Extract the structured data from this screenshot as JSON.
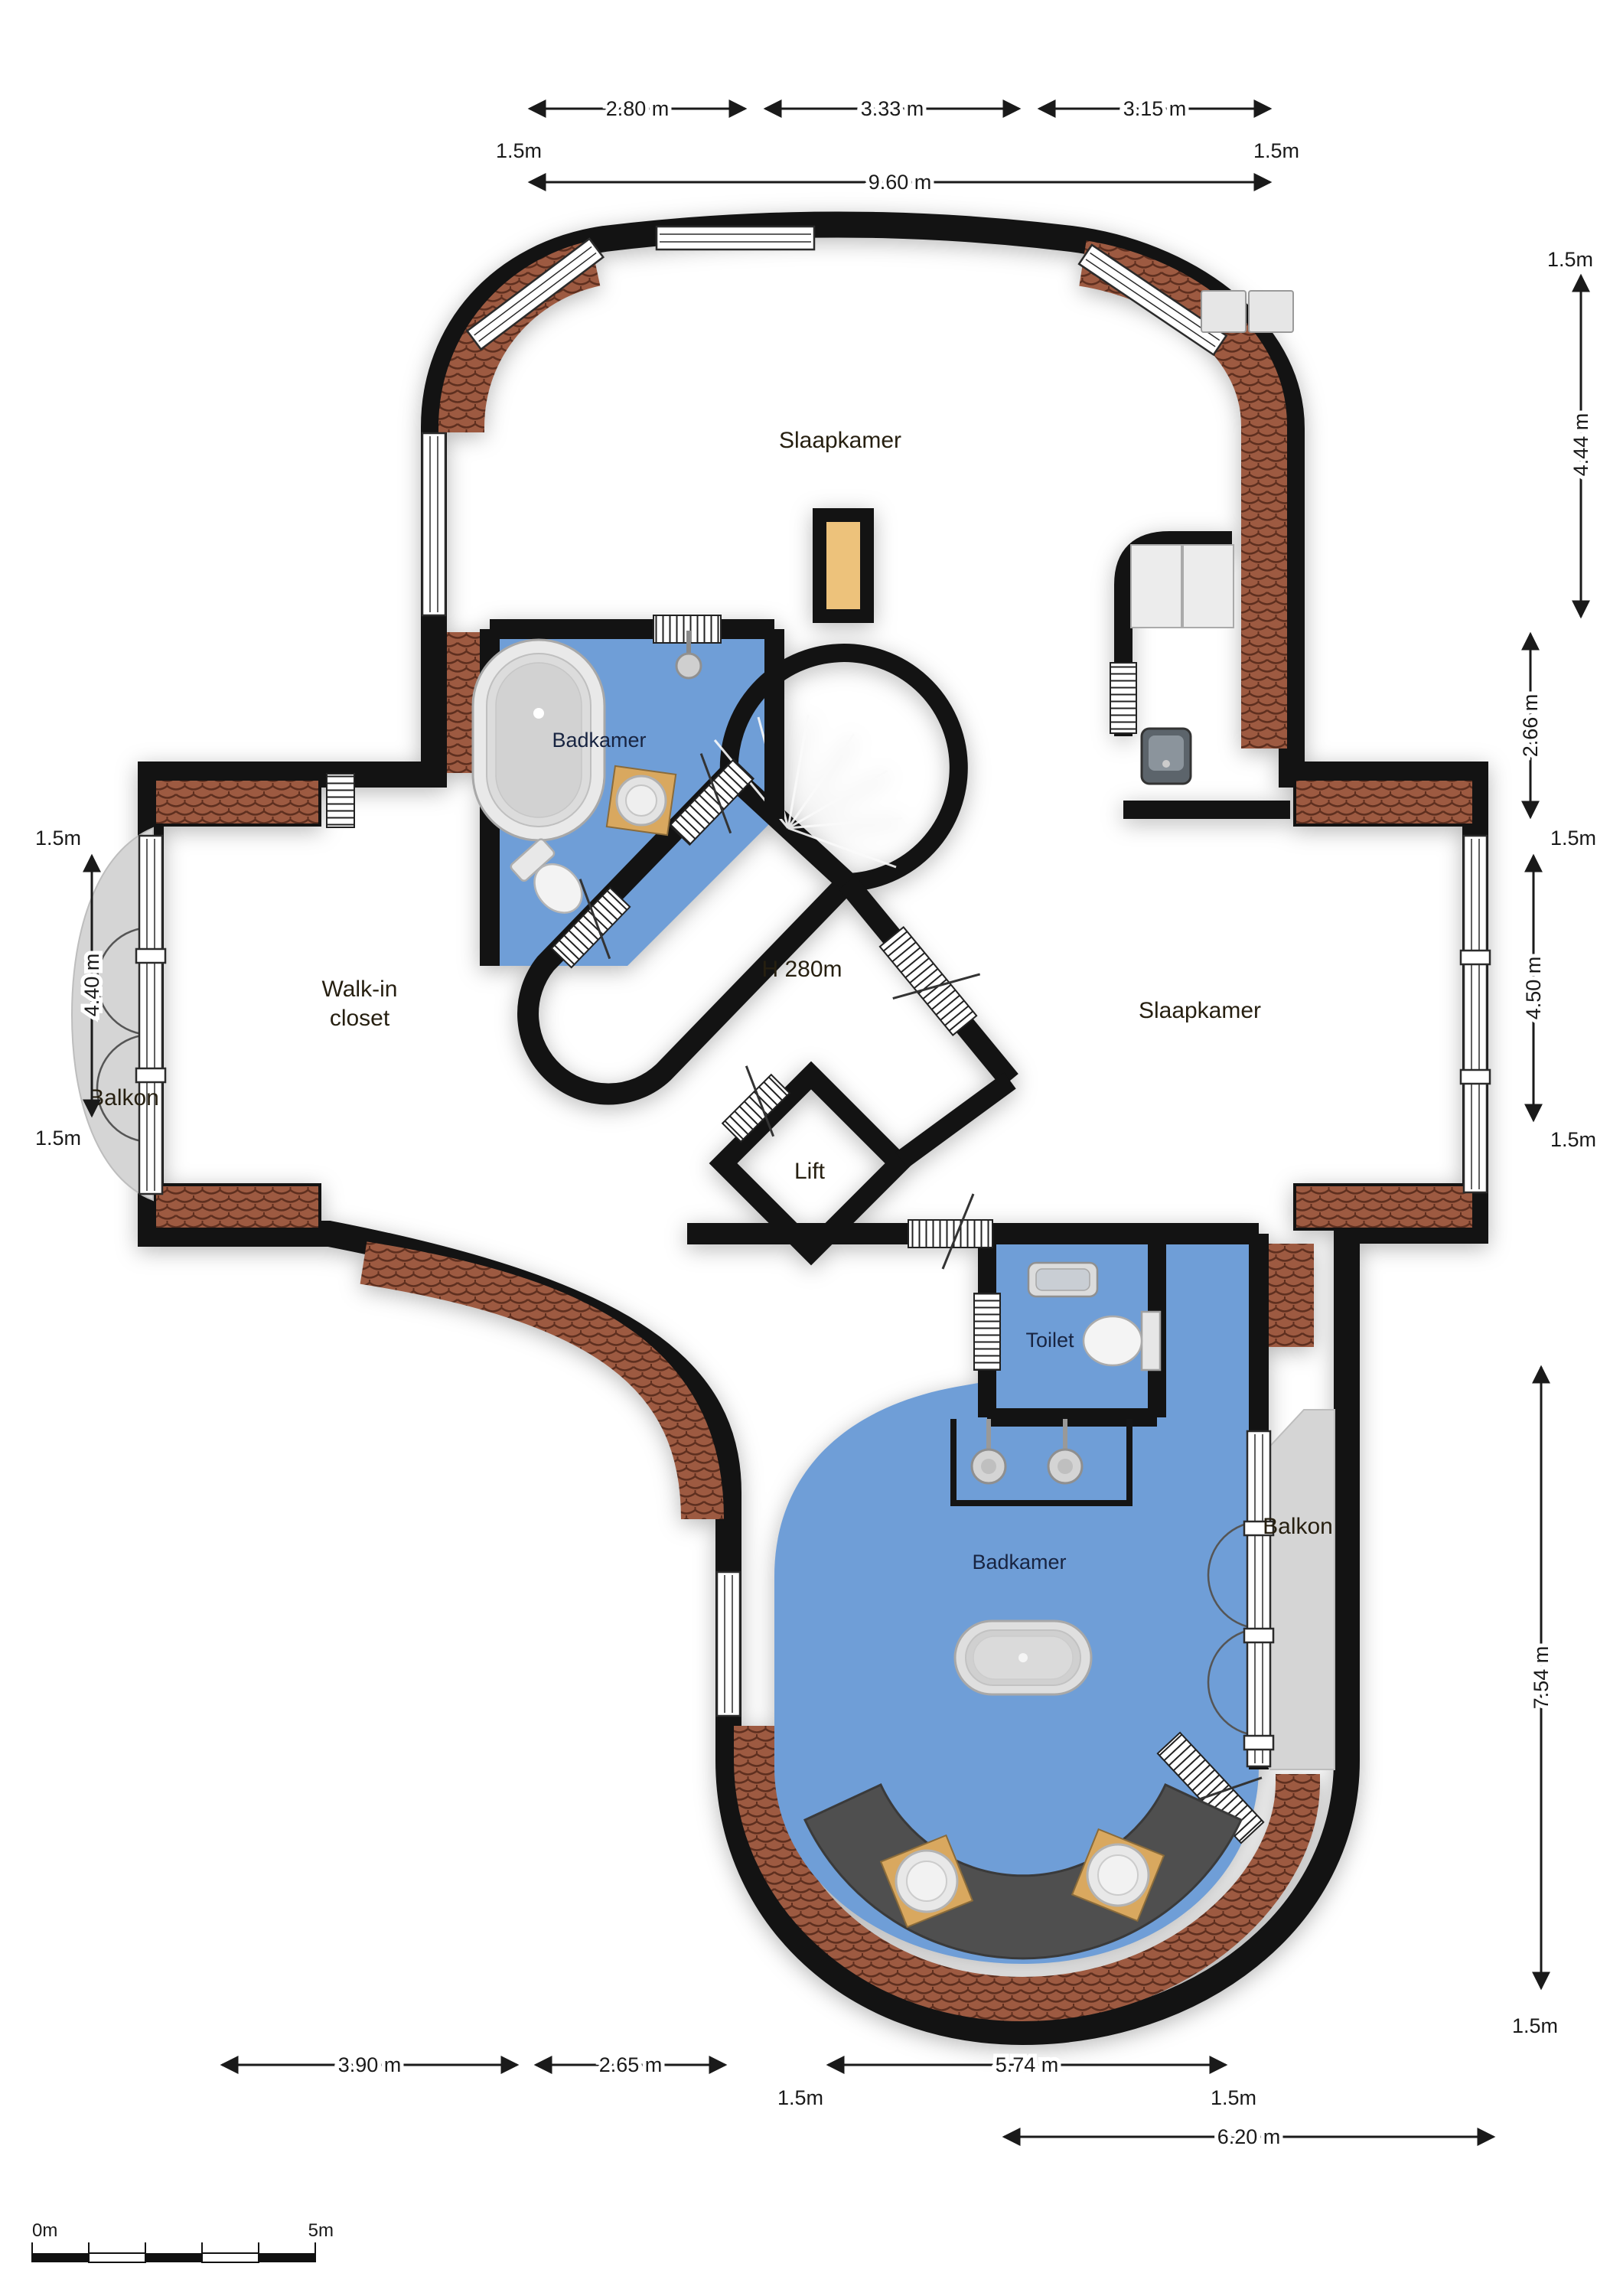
{
  "rooms": {
    "slaapkamer_top": "Slaapkamer",
    "badkamer_top": "Badkamer",
    "walk_in_closet_line1": "Walk-in",
    "walk_in_closet_line2": "closet",
    "ceiling_height": "H 280m",
    "slaapkamer_right": "Slaapkamer",
    "lift": "Lift",
    "toilet": "Toilet",
    "badkamer_bottom": "Badkamer",
    "balkon_left": "Balkon",
    "balkon_right": "Balkon"
  },
  "dimensions": {
    "top": {
      "segments": [
        "2.80 m",
        "3.33 m",
        "3.15 m"
      ],
      "offset_left": "1.5m",
      "offset_right": "1.5m",
      "overall": "9.60 m"
    },
    "right": {
      "offset_top": "1.5m",
      "upper": "4.44 m",
      "mid": "2.66 m",
      "offset_mid_top": "1.5m",
      "bedroom": "4.50 m",
      "offset_mid_bottom": "1.5m",
      "lower": "7.54 m",
      "offset_bottom": "1.5m"
    },
    "left": {
      "offset_top": "1.5m",
      "height": "4.40 m",
      "offset_bottom": "1.5m"
    },
    "bottom": {
      "seg1": "3.90 m",
      "seg2": "2.65 m",
      "offset_left": "1.5m",
      "seg3": "5.74 m",
      "offset_right": "1.5m",
      "overall": "6.20 m"
    }
  },
  "scale_bar": {
    "start": "0m",
    "end": "5m"
  },
  "colors": {
    "floor": "#edc27b",
    "bathroom": "#6f9ed7",
    "balcony": "#d5d5d5",
    "lift": "#d8d8d8",
    "wall": "#131313",
    "brick": "#9d5a41",
    "brick_line": "#5e2f1f",
    "counter": "#4f4f4f",
    "stair": "#d6d6d6"
  }
}
